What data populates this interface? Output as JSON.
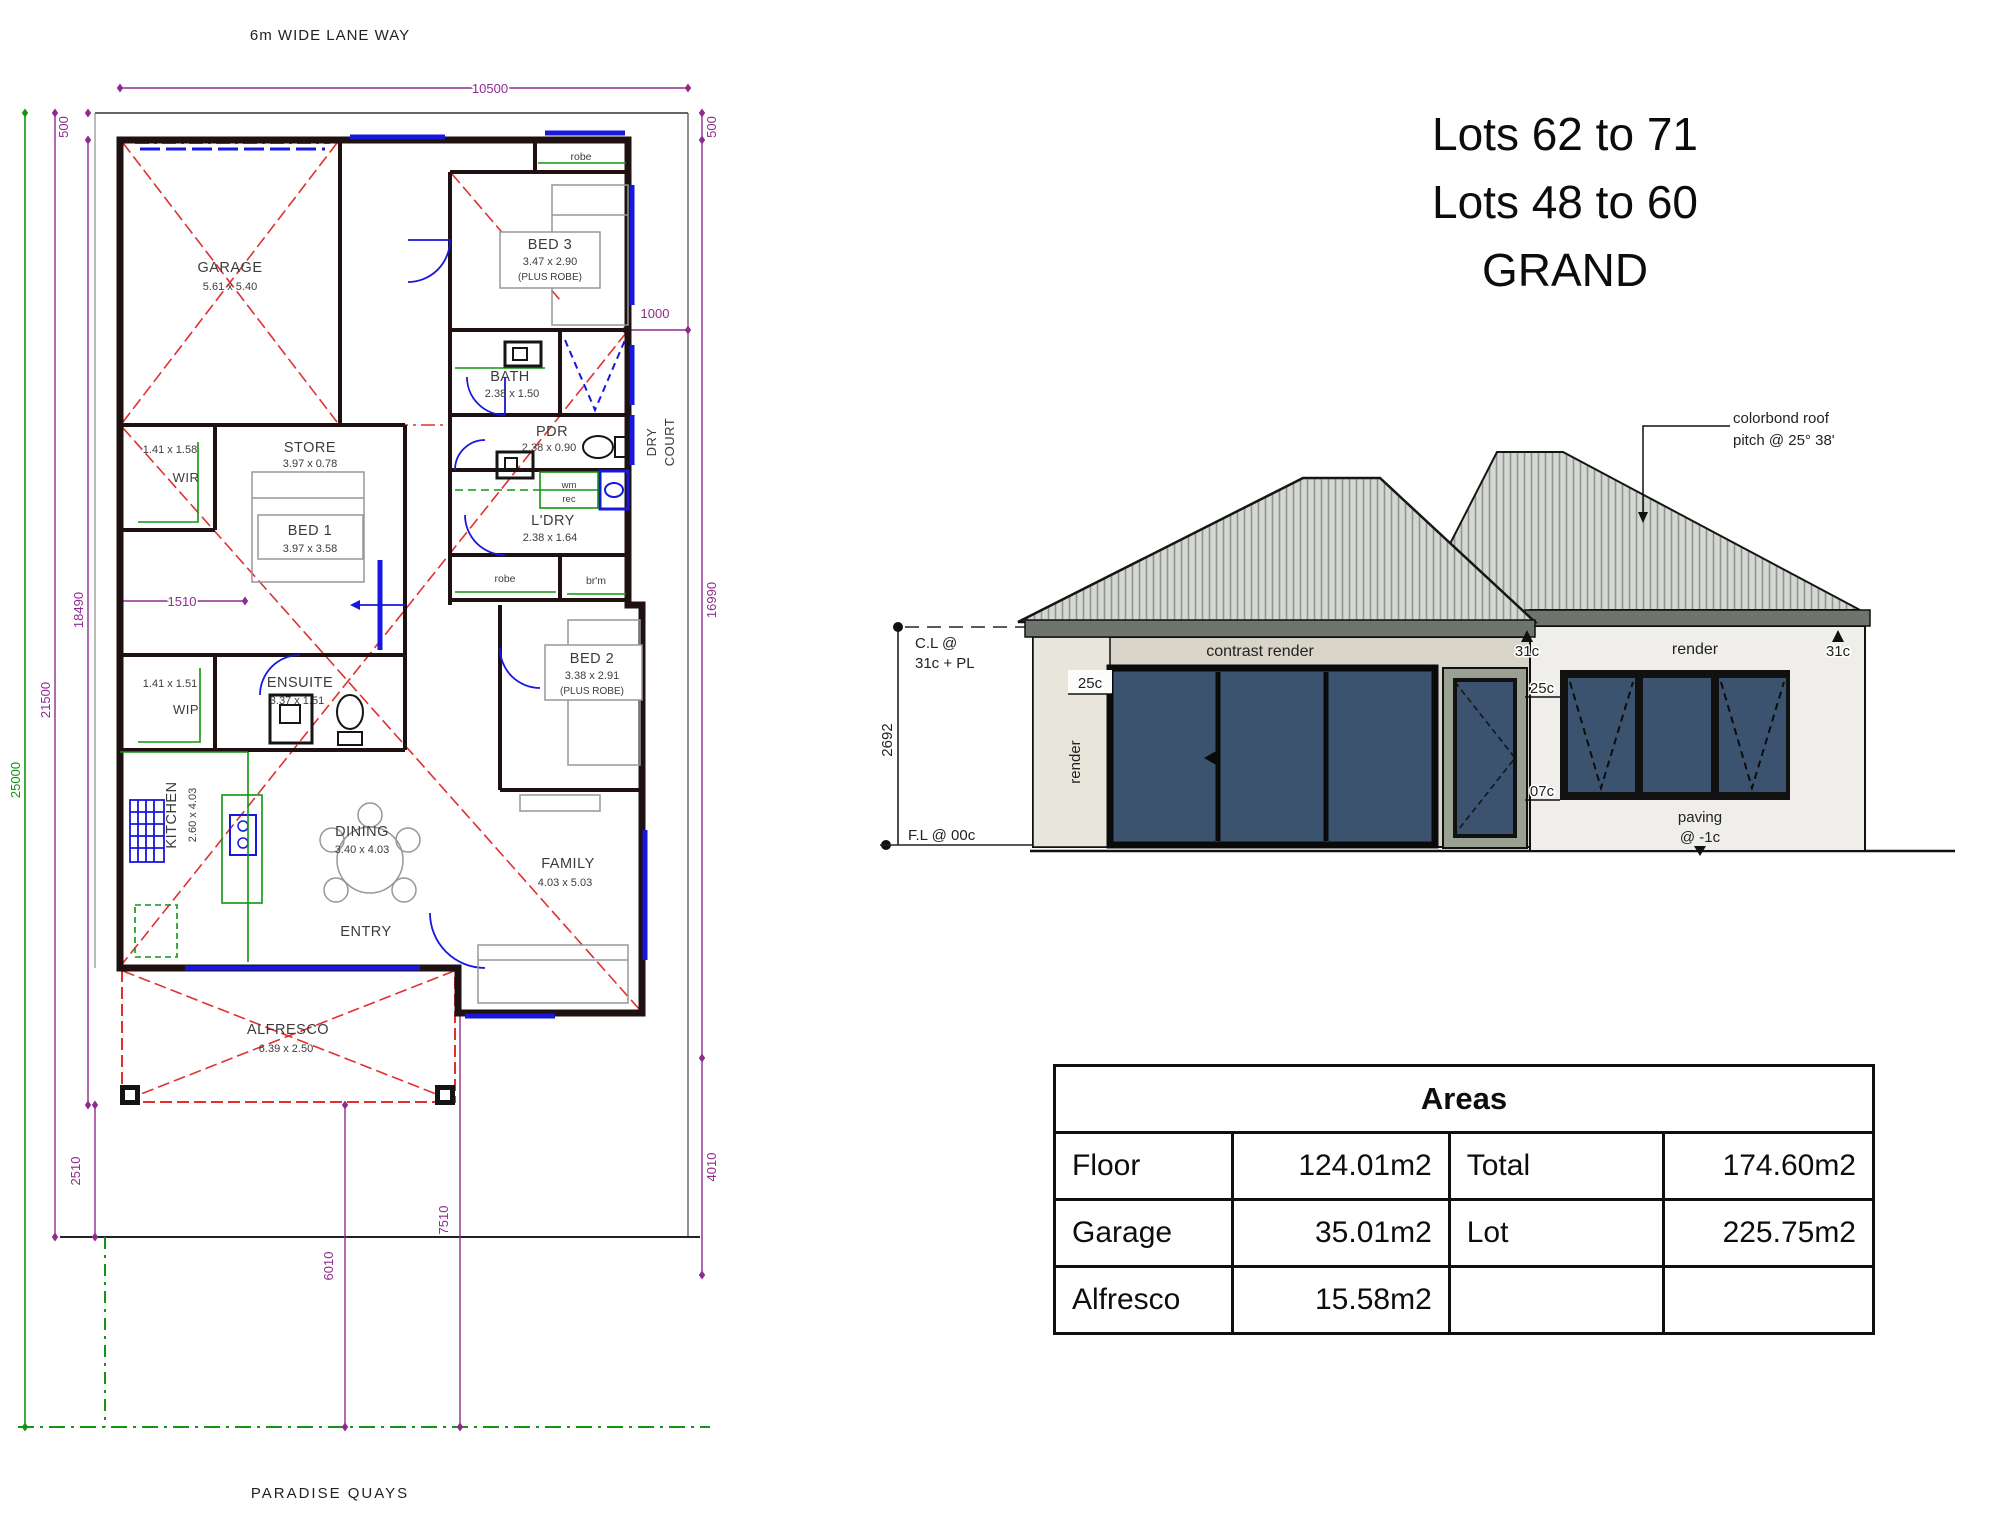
{
  "title": {
    "line1": "Lots 62 to 71",
    "line2": "Lots 48 to 60",
    "line3": "GRAND"
  },
  "plan": {
    "lane_label": "6m WIDE LANE WAY",
    "street_label": "PARADISE QUAYS",
    "dims": {
      "top": "10500",
      "lot_depth": "25000",
      "depth2": "21500",
      "depth3": "18490",
      "front_setback": "500",
      "right_setback": "500",
      "side_court": "1000",
      "house_depth": "16990",
      "rear1": "4010",
      "rear2": "7510",
      "rear3": "6010",
      "wir_offset": "1510",
      "rear_setback": "2510"
    },
    "dry_court": {
      "line1": "DRY",
      "line2": "COURT"
    },
    "rooms": {
      "garage": {
        "name": "GARAGE",
        "size": "5.61 x 5.40"
      },
      "bed3": {
        "name": "BED 3",
        "size": "3.47 x 2.90",
        "note": "(PLUS ROBE)"
      },
      "bath": {
        "name": "BATH",
        "size": "2.38 x 1.50"
      },
      "pdr": {
        "name": "PDR",
        "size": "2.38 x 0.90"
      },
      "ldry": {
        "name": "L'DRY",
        "size": "2.38 x 1.64"
      },
      "store": {
        "name": "STORE",
        "size": "3.97 x 0.78"
      },
      "wir": {
        "name": "WIR",
        "size": "1.41 x 1.58"
      },
      "bed1": {
        "name": "BED 1",
        "size": "3.97 x 3.58"
      },
      "ensuite": {
        "name": "ENSUITE",
        "size": "3.37 x 1.51"
      },
      "wip": {
        "name": "WIP",
        "size": "1.41 x 1.51"
      },
      "bed2": {
        "name": "BED 2",
        "size": "3.38 x 2.91",
        "note": "(PLUS ROBE)"
      },
      "family": {
        "name": "FAMILY",
        "size": "4.03 x 5.03"
      },
      "dining": {
        "name": "DINING",
        "size": "3.40 x 4.03"
      },
      "kitchen": {
        "name": "KITCHEN",
        "size": "2.60 x 4.03"
      },
      "entry": {
        "name": "ENTRY"
      },
      "alfresco": {
        "name": "ALFRESCO",
        "size": "6.39 x 2.50"
      }
    },
    "fixtures": {
      "robe_top": "robe",
      "robe_hall": "robe",
      "broom": "br'm",
      "wm": "wm",
      "rec": "rec"
    }
  },
  "elevation": {
    "roof_note_line1": "colorbond roof",
    "roof_note_line2": "pitch @ 25° 38'",
    "ceiling_line1": "C.L @",
    "ceiling_line2": "31c + PL",
    "height_dim": "2692",
    "floor_level": "F.L @ 00c",
    "wall_left": "contrast render",
    "wall_right": "render",
    "pier": "render",
    "marker_25_left": "25c",
    "marker_25_right": "25c",
    "marker_07": "07c",
    "marker_31_left": "31c",
    "marker_31_right": "31c",
    "paving_line1": "paving",
    "paving_line2": "@ -1c",
    "colors": {
      "window": "#3b536e",
      "wall_beige": "#d8d4c8",
      "wall_light": "#efeeea",
      "roof": "#d4d7d2"
    }
  },
  "areas_table": {
    "title": "Areas",
    "rows": [
      [
        "Floor",
        "124.01m2",
        "Total",
        "174.60m2"
      ],
      [
        "Garage",
        "35.01m2",
        "Lot",
        "225.75m2"
      ],
      [
        "Alfresco",
        "15.58m2",
        "",
        ""
      ]
    ]
  }
}
